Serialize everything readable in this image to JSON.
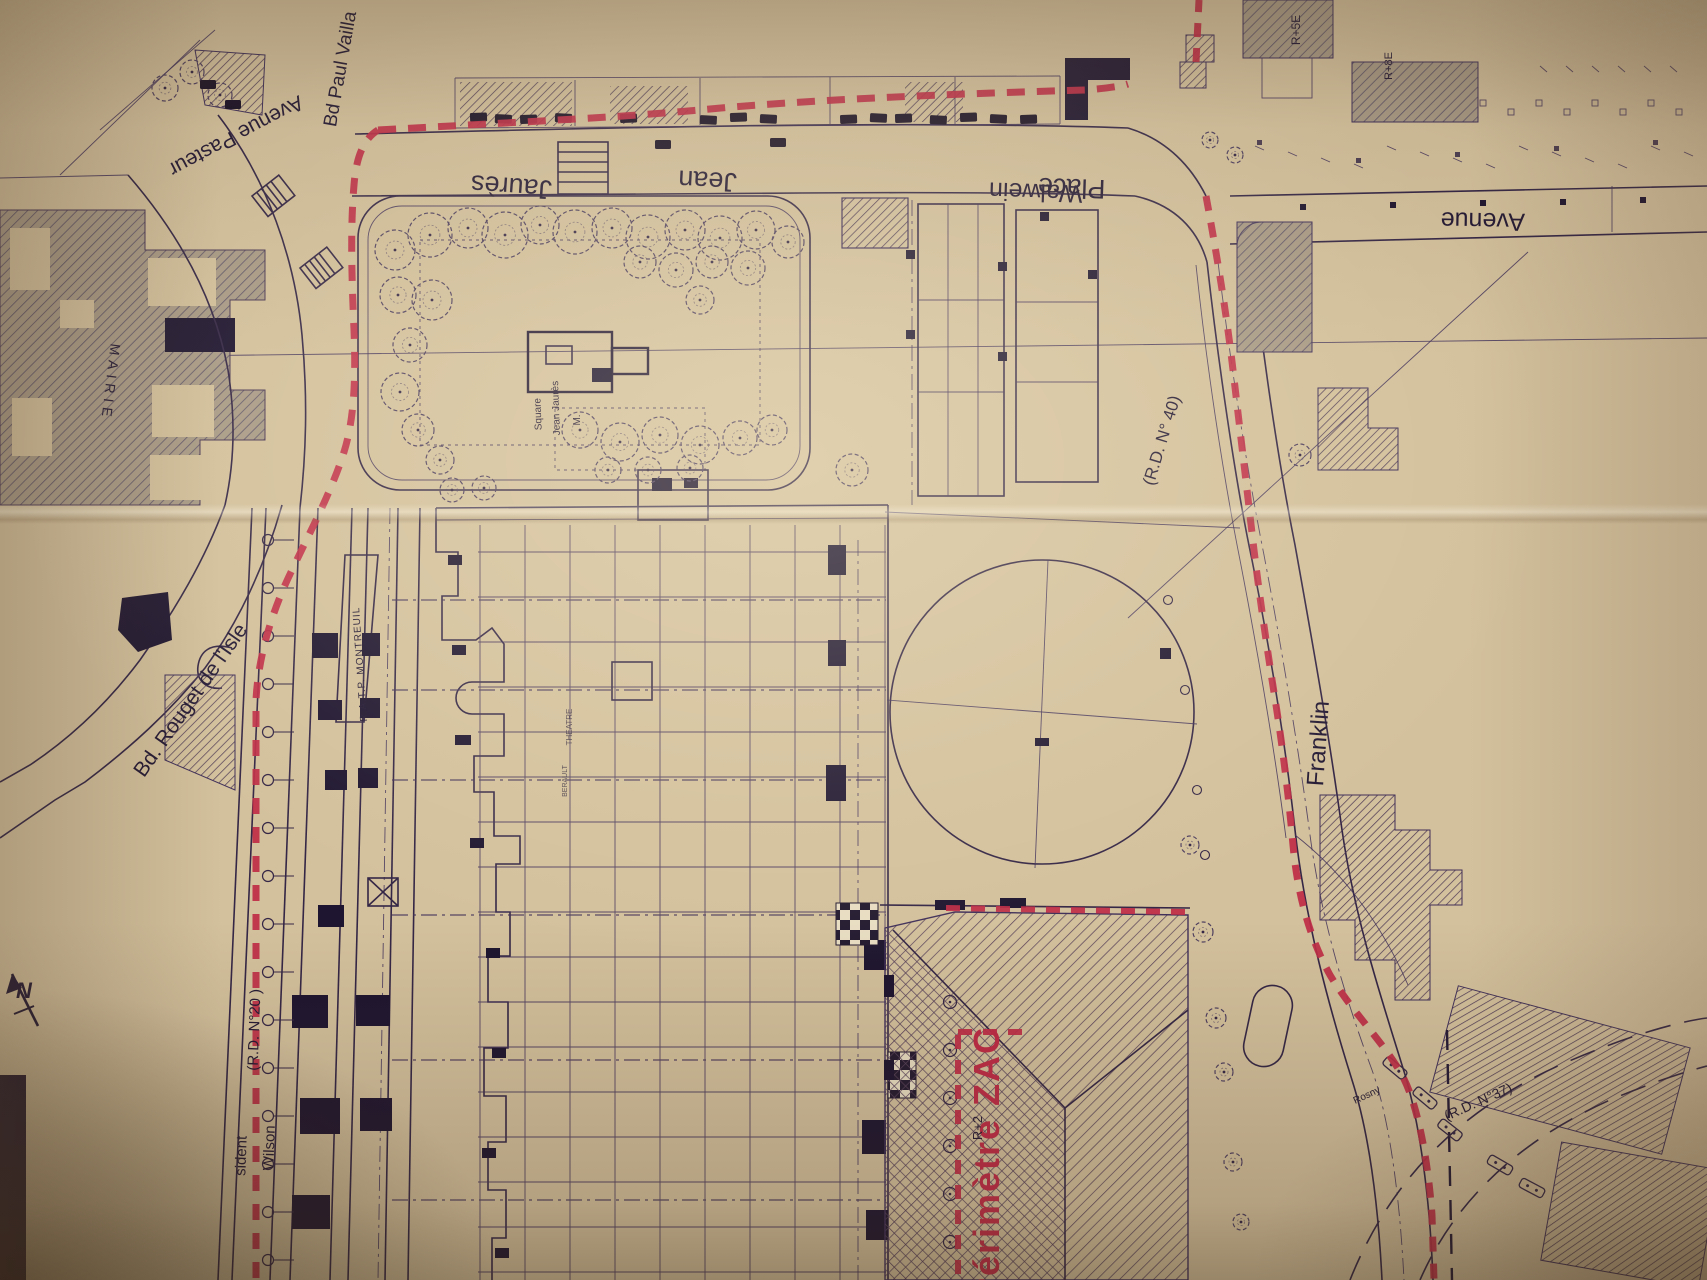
{
  "document": {
    "type": "photographed-urban-plan",
    "subject": "ZAC perimeter plan around Place Jean Jaurès and the Mairie"
  },
  "colors": {
    "paper": "#d3c09c",
    "ink": "#342646",
    "perimeter_red": "#bf2c46",
    "gray_fill": "#a39685"
  },
  "labels": {
    "avenue_pasteur": "Avenue Pasteur",
    "bd_paul_vailla": "Bd Paul Vailla",
    "jaures": "Jaurès",
    "jean": "Jean",
    "place": "Place",
    "walwein": "Walwein",
    "avenue": "Avenue",
    "mairie": "MAIRIE",
    "square_line1": "Square",
    "square_line2": "Jean Jaurès",
    "m_marker": "M.",
    "rd40": "(R.D. N° 40)",
    "rouget": "Bd. Rouget de l'Isle",
    "franklin": "Franklin",
    "ratp": "R.A.T.P. MONTREUIL",
    "rd20": "(R.D. N°20 )",
    "wilson": "Wilson",
    "president_partial": "sident",
    "perimetre_zac": "Périmètre ZAC",
    "r2": "R+2",
    "r5e": "R+5E",
    "r8e": "R+8E",
    "rosny": "Rosny",
    "rd37": "(R.D. N°37)",
    "north": "N",
    "shop_small_1": "THEATRE",
    "shop_small_2": "BERAULT"
  }
}
